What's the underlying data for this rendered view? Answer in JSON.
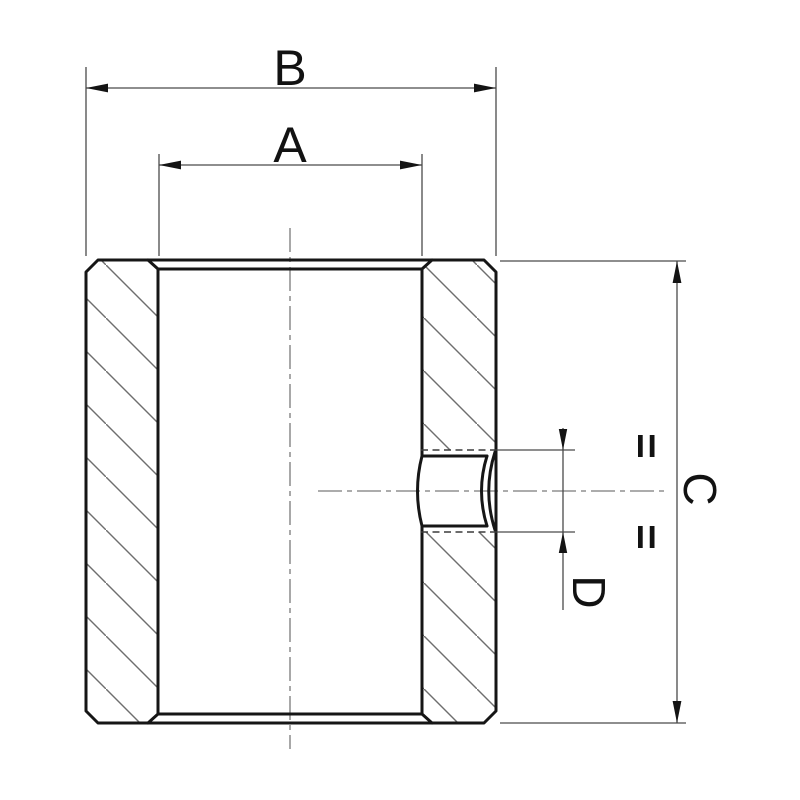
{
  "drawing": {
    "labels": {
      "width_overall": "B",
      "width_bore": "A",
      "height_overall": "C",
      "hole_diameter": "D"
    },
    "symmetry_symbol": "=",
    "colors": {
      "background": "#ffffff",
      "outline": "#161616",
      "dimension_lines": "#4a4a4a",
      "centerline": "#7a7a7a",
      "hatch": "#6e6e6e",
      "text": "#121212"
    }
  }
}
